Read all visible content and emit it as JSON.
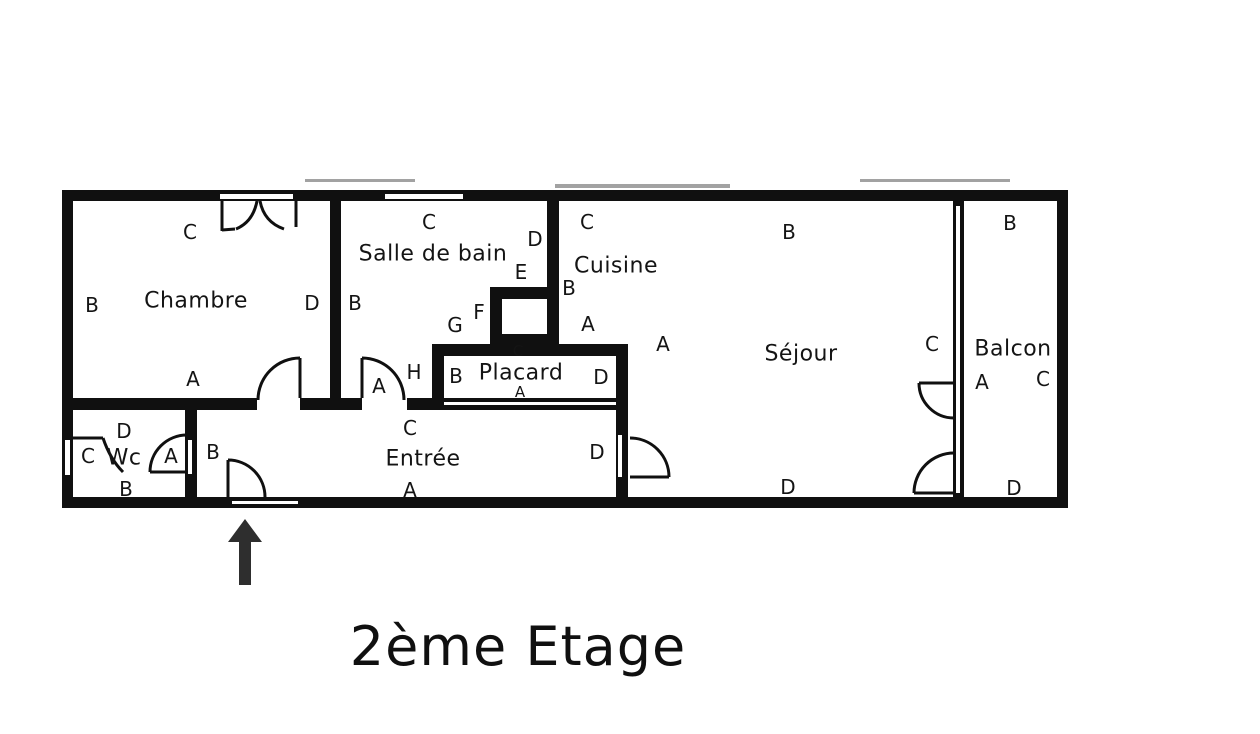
{
  "title": {
    "text": "2ème Etage"
  },
  "colors": {
    "wall": "#101010",
    "background": "#ffffff",
    "arrow": "#2e2e2e"
  },
  "icons": {
    "entrance_arrow": "arrow-up"
  },
  "floor_plan": {
    "rooms": [
      {
        "id": "chambre",
        "name": "Chambre",
        "name_pos": {
          "x": 196,
          "y": 301
        },
        "wall_labels": [
          {
            "t": "C",
            "x": 190,
            "y": 232
          },
          {
            "t": "B",
            "x": 92,
            "y": 305
          },
          {
            "t": "D",
            "x": 312,
            "y": 303
          },
          {
            "t": "A",
            "x": 193,
            "y": 379
          }
        ]
      },
      {
        "id": "salle-de-bain",
        "name": "Salle de bain",
        "name_pos": {
          "x": 433,
          "y": 254
        },
        "wall_labels": [
          {
            "t": "C",
            "x": 429,
            "y": 222
          },
          {
            "t": "B",
            "x": 355,
            "y": 303
          },
          {
            "t": "D",
            "x": 535,
            "y": 239
          },
          {
            "t": "E",
            "x": 521,
            "y": 272
          },
          {
            "t": "F",
            "x": 479,
            "y": 312
          },
          {
            "t": "G",
            "x": 455,
            "y": 325
          },
          {
            "t": "H",
            "x": 414,
            "y": 372
          },
          {
            "t": "A",
            "x": 379,
            "y": 386
          }
        ]
      },
      {
        "id": "cuisine",
        "name": "Cuisine",
        "name_pos": {
          "x": 616,
          "y": 266
        },
        "wall_labels": [
          {
            "t": "C",
            "x": 587,
            "y": 222
          },
          {
            "t": "B",
            "x": 569,
            "y": 288
          },
          {
            "t": "A",
            "x": 588,
            "y": 324
          }
        ]
      },
      {
        "id": "sejour",
        "name": "Séjour",
        "name_pos": {
          "x": 801,
          "y": 354
        },
        "wall_labels": [
          {
            "t": "B",
            "x": 789,
            "y": 232
          },
          {
            "t": "A",
            "x": 663,
            "y": 344
          },
          {
            "t": "C",
            "x": 932,
            "y": 344
          },
          {
            "t": "D",
            "x": 788,
            "y": 487
          }
        ]
      },
      {
        "id": "balcon",
        "name": "Balcon",
        "name_pos": {
          "x": 1013,
          "y": 349
        },
        "wall_labels": [
          {
            "t": "B",
            "x": 1010,
            "y": 223
          },
          {
            "t": "A",
            "x": 982,
            "y": 382
          },
          {
            "t": "C",
            "x": 1043,
            "y": 379
          },
          {
            "t": "D",
            "x": 1014,
            "y": 488
          }
        ]
      },
      {
        "id": "wc",
        "name": "Wc",
        "name_pos": {
          "x": 124,
          "y": 458
        },
        "wall_labels": [
          {
            "t": "D",
            "x": 124,
            "y": 431
          },
          {
            "t": "C",
            "x": 88,
            "y": 456
          },
          {
            "t": "A",
            "x": 171,
            "y": 456
          },
          {
            "t": "B",
            "x": 126,
            "y": 489
          }
        ]
      },
      {
        "id": "entree",
        "name": "Entrée",
        "name_pos": {
          "x": 423,
          "y": 459
        },
        "wall_labels": [
          {
            "t": "C",
            "x": 410,
            "y": 428
          },
          {
            "t": "A",
            "x": 410,
            "y": 490
          },
          {
            "t": "B",
            "x": 213,
            "y": 452
          },
          {
            "t": "D",
            "x": 597,
            "y": 452
          }
        ]
      },
      {
        "id": "placard",
        "name": "Placard",
        "name_pos": {
          "x": 521,
          "y": 373
        },
        "wall_labels": [
          {
            "t": "B",
            "x": 456,
            "y": 376
          },
          {
            "t": "D",
            "x": 601,
            "y": 377
          },
          {
            "t": "C",
            "x": 518,
            "y": 351,
            "small": true
          },
          {
            "t": "A",
            "x": 520,
            "y": 392,
            "small": true
          }
        ]
      }
    ]
  }
}
